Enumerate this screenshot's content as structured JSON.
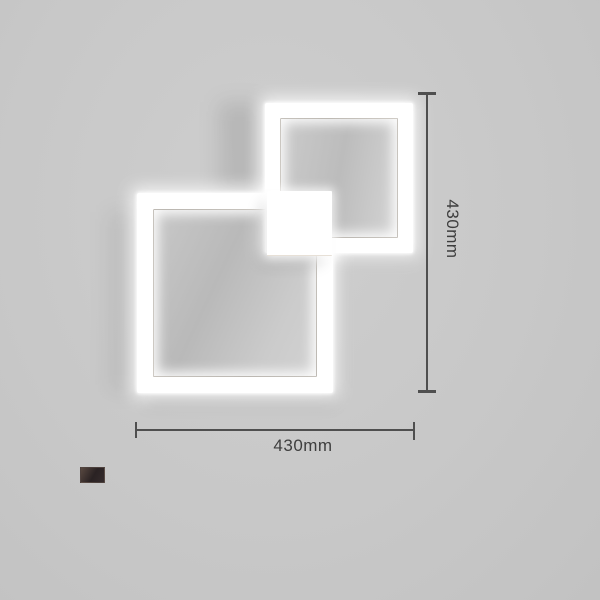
{
  "page": {
    "type": "product-dimension-image",
    "background_color": "#c9c9c9"
  },
  "lamp": {
    "name": "overlapping-square-led-lamp",
    "frame_color": "#ffffff"
  },
  "dimensions": {
    "line_color": "#4f4f4f",
    "text_color": "#3e3e3e",
    "height": {
      "label": "430mm"
    },
    "width": {
      "label": "430mm"
    }
  },
  "swatch": {
    "name": "dark-coffee-finish",
    "color": "#34292a"
  }
}
